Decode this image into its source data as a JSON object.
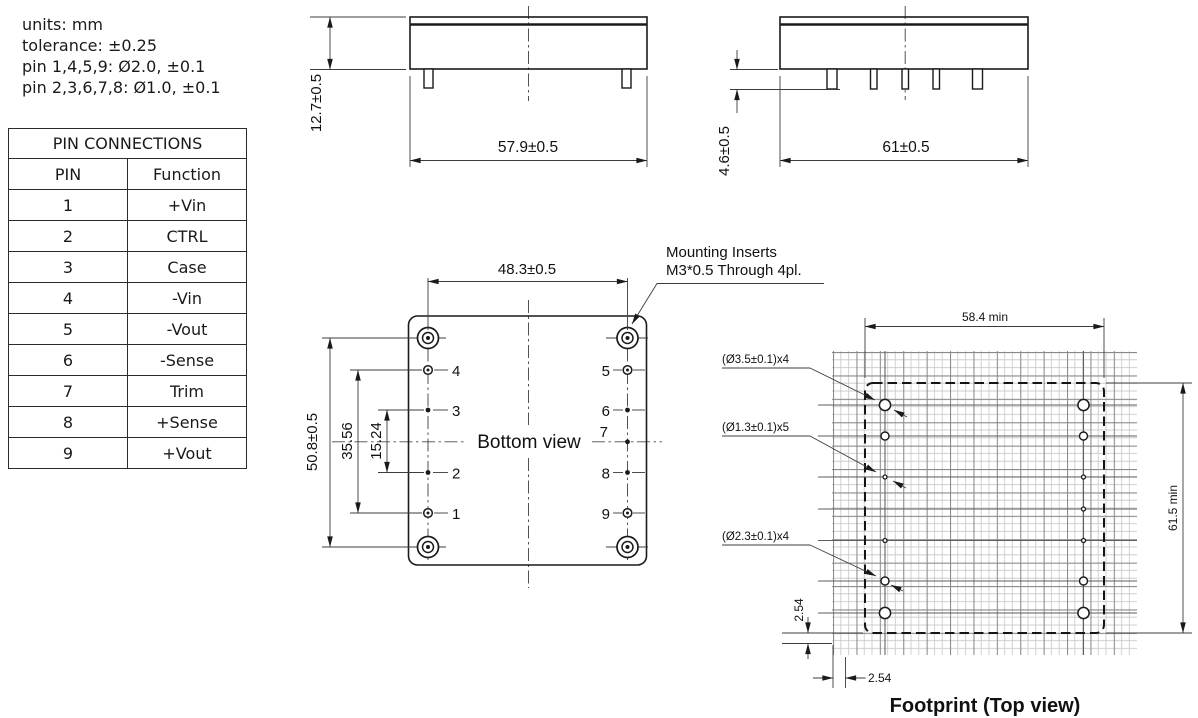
{
  "notes": {
    "lines": [
      "units: mm",
      "tolerance: ±0.25",
      "pin 1,4,5,9: Ø2.0, ±0.1",
      "pin 2,3,6,7,8: Ø1.0, ±0.1"
    ]
  },
  "pin_table": {
    "title": "PIN CONNECTIONS",
    "headers": {
      "pin": "PIN",
      "function": "Function"
    },
    "rows": [
      {
        "pin": "1",
        "function": "+Vin"
      },
      {
        "pin": "2",
        "function": "CTRL"
      },
      {
        "pin": "3",
        "function": "Case"
      },
      {
        "pin": "4",
        "function": "-Vin"
      },
      {
        "pin": "5",
        "function": "-Vout"
      },
      {
        "pin": "6",
        "function": "-Sense"
      },
      {
        "pin": "7",
        "function": "Trim"
      },
      {
        "pin": "8",
        "function": "+Sense"
      },
      {
        "pin": "9",
        "function": "+Vout"
      }
    ]
  },
  "front_view": {
    "height_dim": "12.7±0.5",
    "width_dim": "57.9±0.5"
  },
  "side_view": {
    "pin_length_dim": "4.6±0.5",
    "width_dim": "61±0.5"
  },
  "bottom_view": {
    "label": "Bottom view",
    "width_dim": "48.3±0.5",
    "height_dim": "50.8±0.5",
    "outer_pin_span_dim": "35.56",
    "inner_pin_span_dim": "15.24",
    "mounting_note": [
      "Mounting Inserts",
      "M3*0.5 Through 4pl."
    ],
    "left_pins": [
      "4",
      "3",
      "2",
      "1"
    ],
    "right_pins": [
      "5",
      "6",
      "7",
      "8",
      "9"
    ]
  },
  "footprint": {
    "label": "Footprint (Top view)",
    "width_dim": "58.4 min",
    "height_dim": "61.5 min",
    "pitch_vertical_dim": "2.54",
    "pitch_horizontal_dim": "2.54",
    "mounting_hole_label": "(Ø3.5±0.1)x4",
    "small_hole_label": "(Ø1.3±0.1)x5",
    "pin_hole_label": "(Ø2.3±0.1)x4"
  },
  "colors": {
    "line": "#1a1a1a",
    "grid_light": "#c6c6c6",
    "grid_dark": "#5e5e5e",
    "background": "#ffffff"
  }
}
